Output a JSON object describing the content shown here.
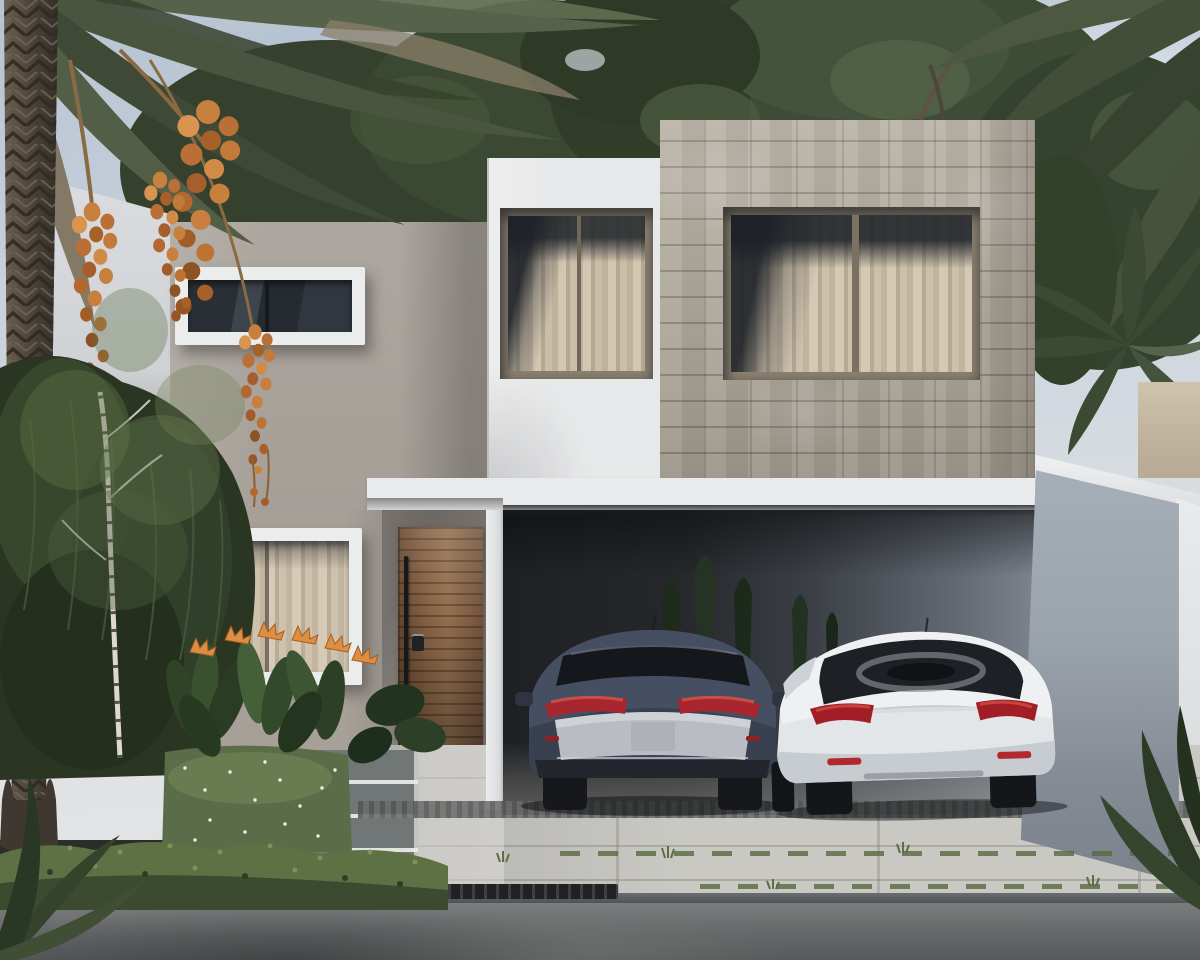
{
  "scene": {
    "label": "exterior-render-two-story-house",
    "setting": [
      "overcast-blue-sky",
      "background-tree-canopy",
      "date-palm-left",
      "palm-trees-right"
    ],
    "house": {
      "volumes": [
        "greige-stucco-volume-left",
        "white-stucco-volume-center",
        "stone-clad-volume-right"
      ],
      "windows": [
        "horizontal-window-upper-left",
        "curtained-window-center-volume",
        "curtained-double-window-stone-volume",
        "curtained-window-ground-floor"
      ],
      "door": "wood-slat-entry-door-with-bar-handle-and-keypad",
      "carport": "open-double-carport-with-dark-interior"
    },
    "vehicles": [
      {
        "name": "sedan-dark-blue-gray",
        "color": "#3f4859"
      },
      {
        "name": "sedan-white",
        "color": "#ecedef"
      }
    ],
    "landscape": [
      "front-garden-bed",
      "bird-of-paradise-flowers",
      "ornamental-grass-hedge",
      "birch-tree",
      "ground-cover-hedge",
      "stepping-stone-path",
      "paved-driveway",
      "sidewalk",
      "storm-drain-grate",
      "asphalt-street",
      "hanging-date-clusters"
    ]
  },
  "palette": {
    "sky_top": "#b7c3d2",
    "sky_mid": "#d7dce1",
    "neighbor_white": "#dcdde0",
    "wall_greige": "#a7a099",
    "wall_white": "#e7e8e9",
    "stone_base": "#b4ac9f",
    "frame_white": "#ebecec",
    "frame_bronze": "#8b8070",
    "curtain_light": "#d8cbb6",
    "curtain_dark": "#b9ac97",
    "slab_white": "#e9eaeb",
    "door_wood": "#8a6547",
    "door_wood_dark": "#70503a",
    "garage_dark": "#1e2023",
    "garage_light": "#7d848d",
    "side_wall_gray": "#9ba3ad",
    "beige_wall": "#cfc3ae",
    "pavement": "#c9c8c3",
    "gravel": "#6a6c6b",
    "street": "#636566",
    "curb": "#54575a",
    "grate": "#1f2123",
    "foliage_dark": "#2a3522",
    "foliage_mid": "#3d4a33",
    "foliage_light": "#55664a",
    "palm_green": "#49553e",
    "palm_dead": "#7e745f",
    "trunk_brown": "#4a4237",
    "dates_orange": "#c8803f",
    "car_dark_body": "#3f4859",
    "car_silver_panel": "#b9bcc2",
    "car_white_body": "#ecedef",
    "tail_light_red": "#a82630",
    "grass_green": "#5a6c48",
    "ground_cover": "#5d7144"
  }
}
